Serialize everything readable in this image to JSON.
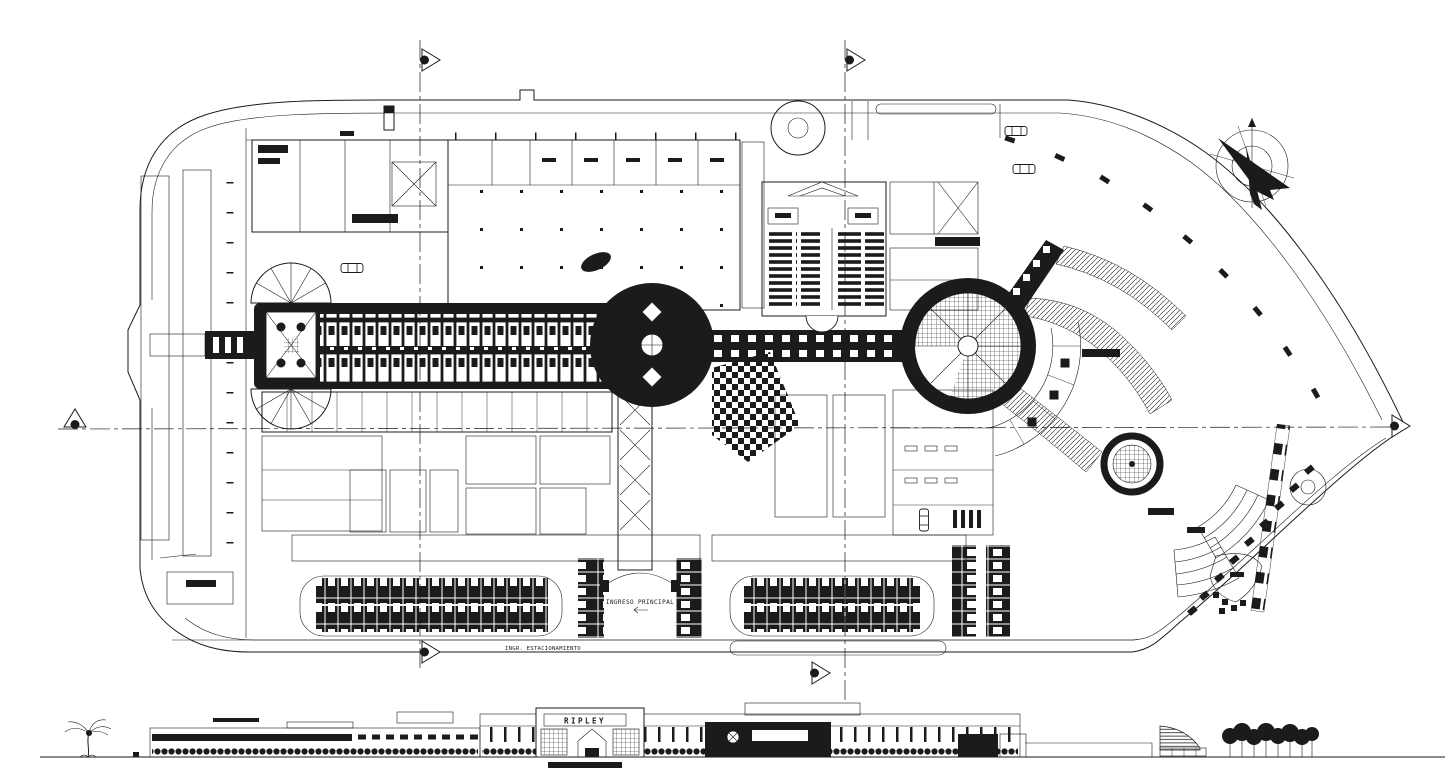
{
  "meta": {
    "drawing_type": "CAD site master plan of a shopping mall with front elevation strip",
    "ink_color": "#1b1b1b",
    "paper_color": "#ffffff"
  },
  "labels": {
    "store_sign": "RIPLEY",
    "main_entrance": "INGRESO PRINCIPAL",
    "parking_entrance": "INGR. ESTACIONAMIENTO"
  }
}
